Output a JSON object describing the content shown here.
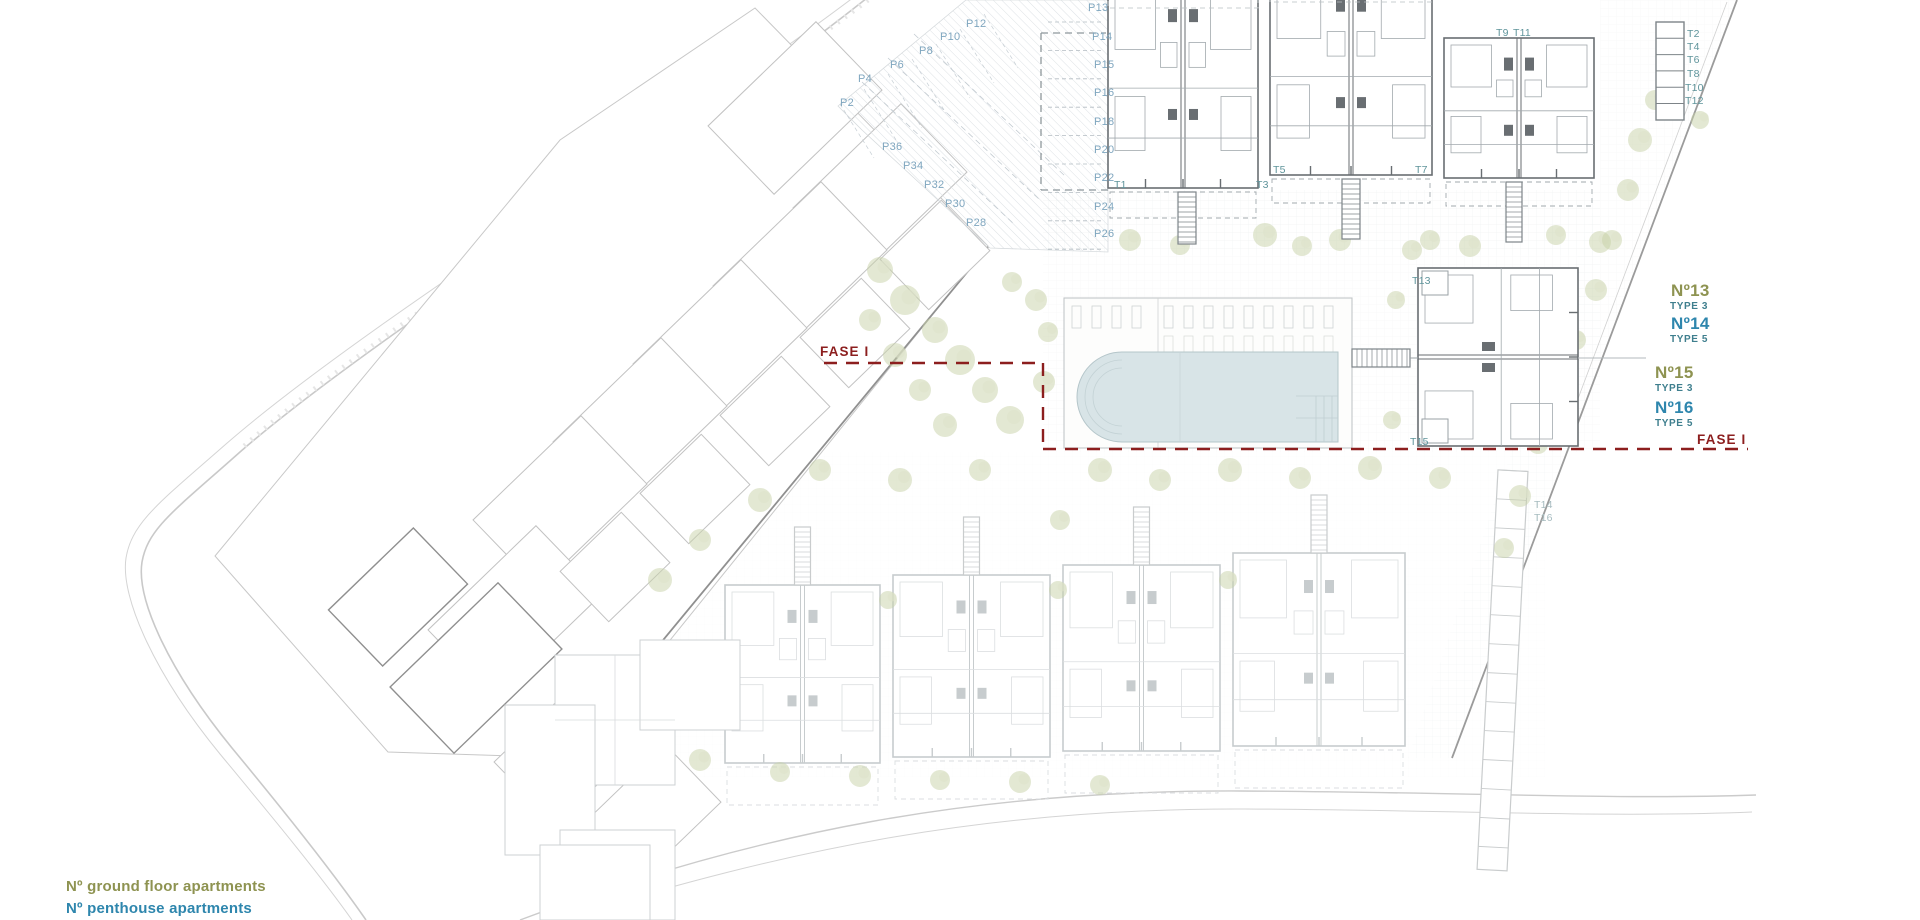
{
  "legend": {
    "ground_floor": "Nº ground floor apartments",
    "penthouse": "Nº penthouse apartments"
  },
  "colors": {
    "parking_label": "#7fa6bf",
    "tower_label": "#5f949b",
    "tower_label_faded": "#a7bcc0",
    "ground_floor_num": "#8e9351",
    "penthouse_num": "#2e86ad",
    "type_label": "#3f7f8e",
    "phase_line": "#8c1e1e",
    "pool_water": "#d8e4e7",
    "vegetation": "#c8d1a8"
  },
  "labels": {
    "parking": [
      {
        "t": "P13",
        "x": 1088,
        "y": 11
      },
      {
        "t": "P14",
        "x": 1092,
        "y": 40
      },
      {
        "t": "P15",
        "x": 1094,
        "y": 68
      },
      {
        "t": "P16",
        "x": 1094,
        "y": 96
      },
      {
        "t": "P18",
        "x": 1094,
        "y": 125
      },
      {
        "t": "P20",
        "x": 1094,
        "y": 153
      },
      {
        "t": "P22",
        "x": 1094,
        "y": 181
      },
      {
        "t": "P24",
        "x": 1094,
        "y": 210
      },
      {
        "t": "P26",
        "x": 1094,
        "y": 237
      },
      {
        "t": "P12",
        "x": 966,
        "y": 27
      },
      {
        "t": "P10",
        "x": 940,
        "y": 40
      },
      {
        "t": "P8",
        "x": 919,
        "y": 54
      },
      {
        "t": "P6",
        "x": 890,
        "y": 68
      },
      {
        "t": "P4",
        "x": 858,
        "y": 82
      },
      {
        "t": "P2",
        "x": 840,
        "y": 106
      },
      {
        "t": "P36",
        "x": 882,
        "y": 150
      },
      {
        "t": "P34",
        "x": 903,
        "y": 169
      },
      {
        "t": "P32",
        "x": 924,
        "y": 188
      },
      {
        "t": "P30",
        "x": 945,
        "y": 207
      },
      {
        "t": "P28",
        "x": 966,
        "y": 226
      }
    ],
    "towers": [
      {
        "t": "T1",
        "x": 1114,
        "y": 188
      },
      {
        "t": "T3",
        "x": 1256,
        "y": 188
      },
      {
        "t": "T5",
        "x": 1273,
        "y": 173
      },
      {
        "t": "T7",
        "x": 1415,
        "y": 173
      },
      {
        "t": "T9",
        "x": 1496,
        "y": 36
      },
      {
        "t": "T11",
        "x": 1513,
        "y": 36
      },
      {
        "t": "T13",
        "x": 1412,
        "y": 284
      },
      {
        "t": "T15",
        "x": 1410,
        "y": 445
      },
      {
        "t": "T14",
        "x": 1534,
        "y": 508,
        "faded": true
      },
      {
        "t": "T16",
        "x": 1534,
        "y": 521,
        "faded": true
      }
    ],
    "storage": [
      {
        "t": "T2",
        "x": 1687,
        "y": 37
      },
      {
        "t": "T4",
        "x": 1687,
        "y": 50
      },
      {
        "t": "T6",
        "x": 1687,
        "y": 63
      },
      {
        "t": "T8",
        "x": 1687,
        "y": 77
      },
      {
        "t": "T10",
        "x": 1685,
        "y": 91
      },
      {
        "t": "T12",
        "x": 1685,
        "y": 104
      }
    ],
    "units": [
      {
        "n": "Nº13",
        "type": "TYPE 3",
        "kind": "ground",
        "nx": 1671,
        "ny": 296,
        "tx": 1670,
        "ty": 309
      },
      {
        "n": "Nº14",
        "type": "TYPE 5",
        "kind": "penthouse",
        "nx": 1671,
        "ny": 329,
        "tx": 1670,
        "ty": 342
      },
      {
        "n": "Nº15",
        "type": "TYPE 3",
        "kind": "ground",
        "nx": 1655,
        "ny": 378,
        "tx": 1655,
        "ty": 391
      },
      {
        "n": "Nº16",
        "type": "TYPE 5",
        "kind": "penthouse",
        "nx": 1655,
        "ny": 413,
        "tx": 1655,
        "ty": 426
      }
    ],
    "fase": [
      {
        "t": "FASE I",
        "x": 820,
        "y": 356
      },
      {
        "t": "FASE I",
        "x": 1697,
        "y": 444
      }
    ]
  }
}
